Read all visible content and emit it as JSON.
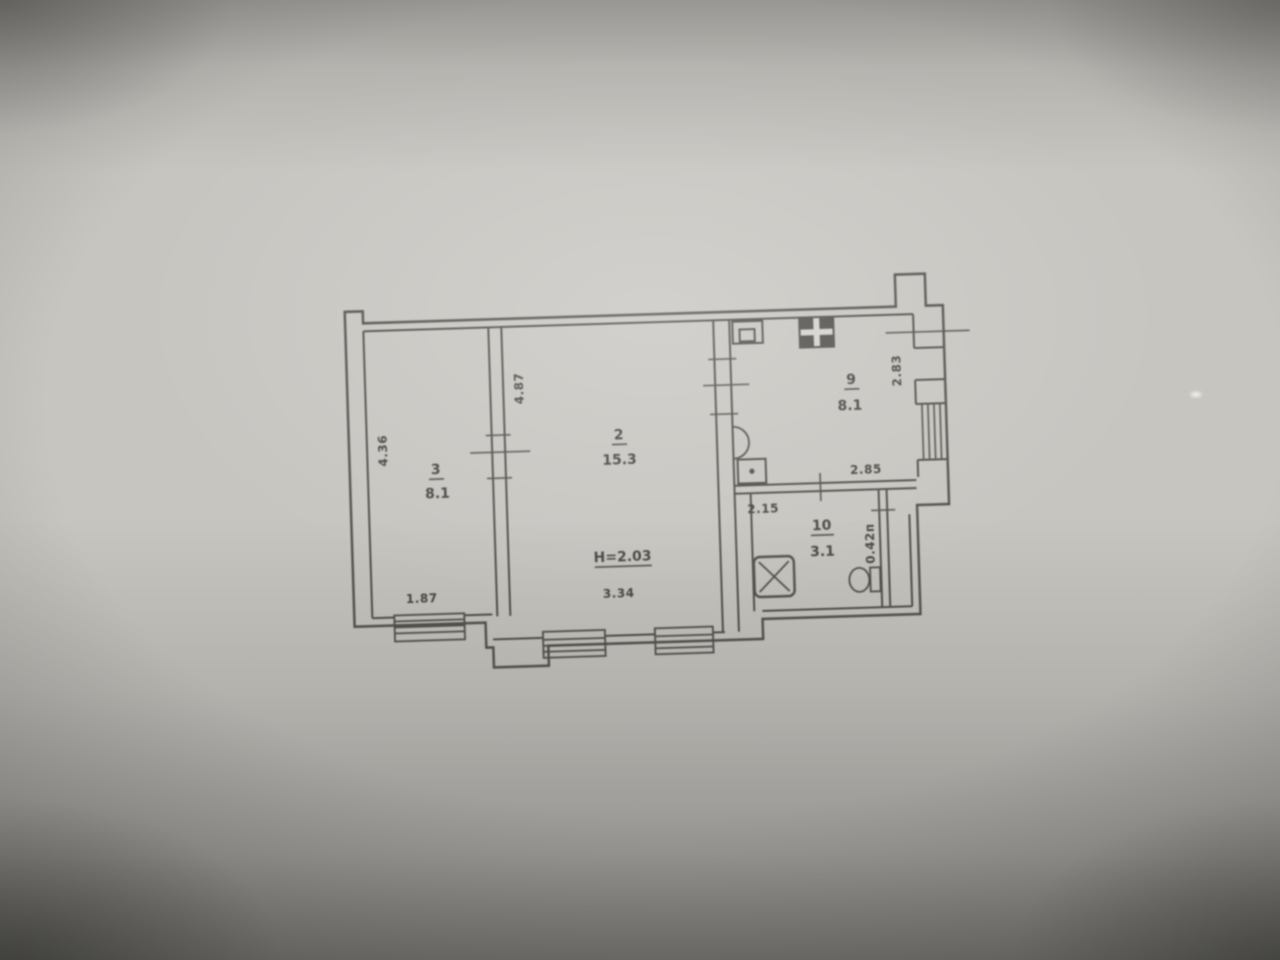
{
  "floorplan": {
    "rooms": [
      {
        "number": "3",
        "area": "8.1"
      },
      {
        "number": "2",
        "area": "15.3"
      },
      {
        "number": "9",
        "area": "8.1"
      },
      {
        "number": "10",
        "area": "3.1"
      }
    ],
    "ceiling_height": "H=2.03",
    "dimensions": {
      "room3_depth": "4.36",
      "room3_window": "1.87",
      "room2_depth": "4.87",
      "room2_window": "3.34",
      "room9_depth": "2.83",
      "room9_width": "2.85",
      "hall_width": "2.15",
      "niche_width": "0.42п"
    }
  }
}
